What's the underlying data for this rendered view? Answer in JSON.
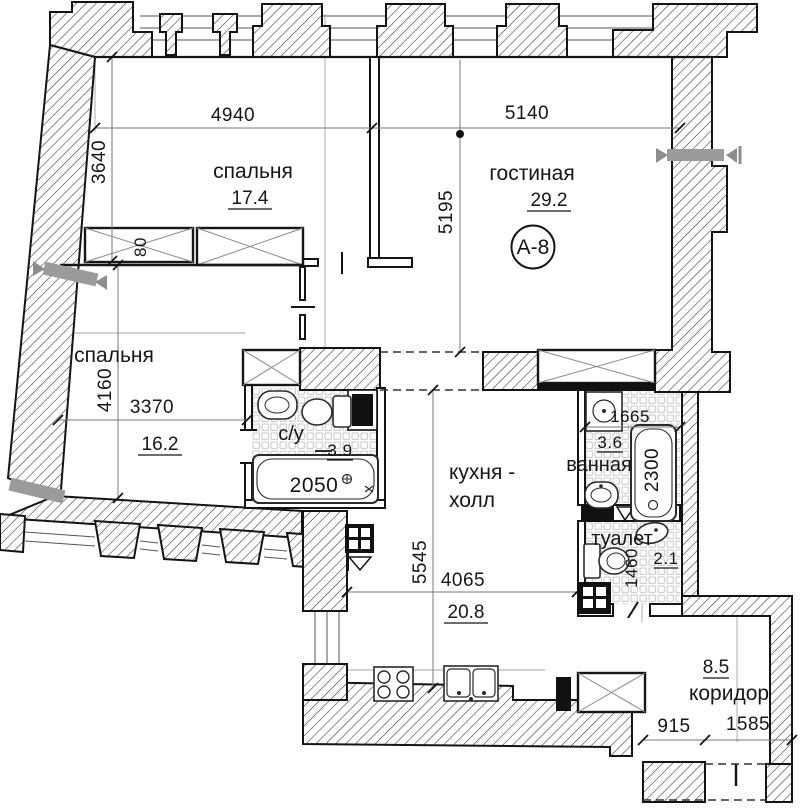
{
  "plan": {
    "apartment_badge": "А-8",
    "rooms": {
      "bedroom1": {
        "name": "спальня",
        "area": "17.4"
      },
      "living": {
        "name": "гостиная",
        "area": "29.2"
      },
      "bedroom2": {
        "name": "спальня",
        "area": "16.2"
      },
      "sanroom": {
        "name": "с/у",
        "area": "3.9"
      },
      "kitchen": {
        "name_line1": "кухня -",
        "name_line2": "холл",
        "area": "20.8"
      },
      "bathroom": {
        "name": "ванная",
        "area": "3.6"
      },
      "wc": {
        "name": "туалет",
        "area": "2.1"
      },
      "corridor": {
        "name": "коридор",
        "area": "8.5"
      }
    },
    "dimensions": {
      "d4940": "4940",
      "d5140": "5140",
      "d3640": "3640",
      "d5195": "5195",
      "d80": "80",
      "d4160": "4160",
      "d3370": "3370",
      "d2050": "2050",
      "d1665": "1665",
      "d2300": "2300",
      "d5545": "5545",
      "d4065": "4065",
      "d1460": "1460",
      "d915": "915",
      "d1585": "1585"
    },
    "colors": {
      "line": "#141414",
      "dim_line": "#777777",
      "axis_gray": "#9a9a9a",
      "lintel_gray": "#9b9b9b",
      "tile_gray": "#c8c8c8"
    }
  }
}
